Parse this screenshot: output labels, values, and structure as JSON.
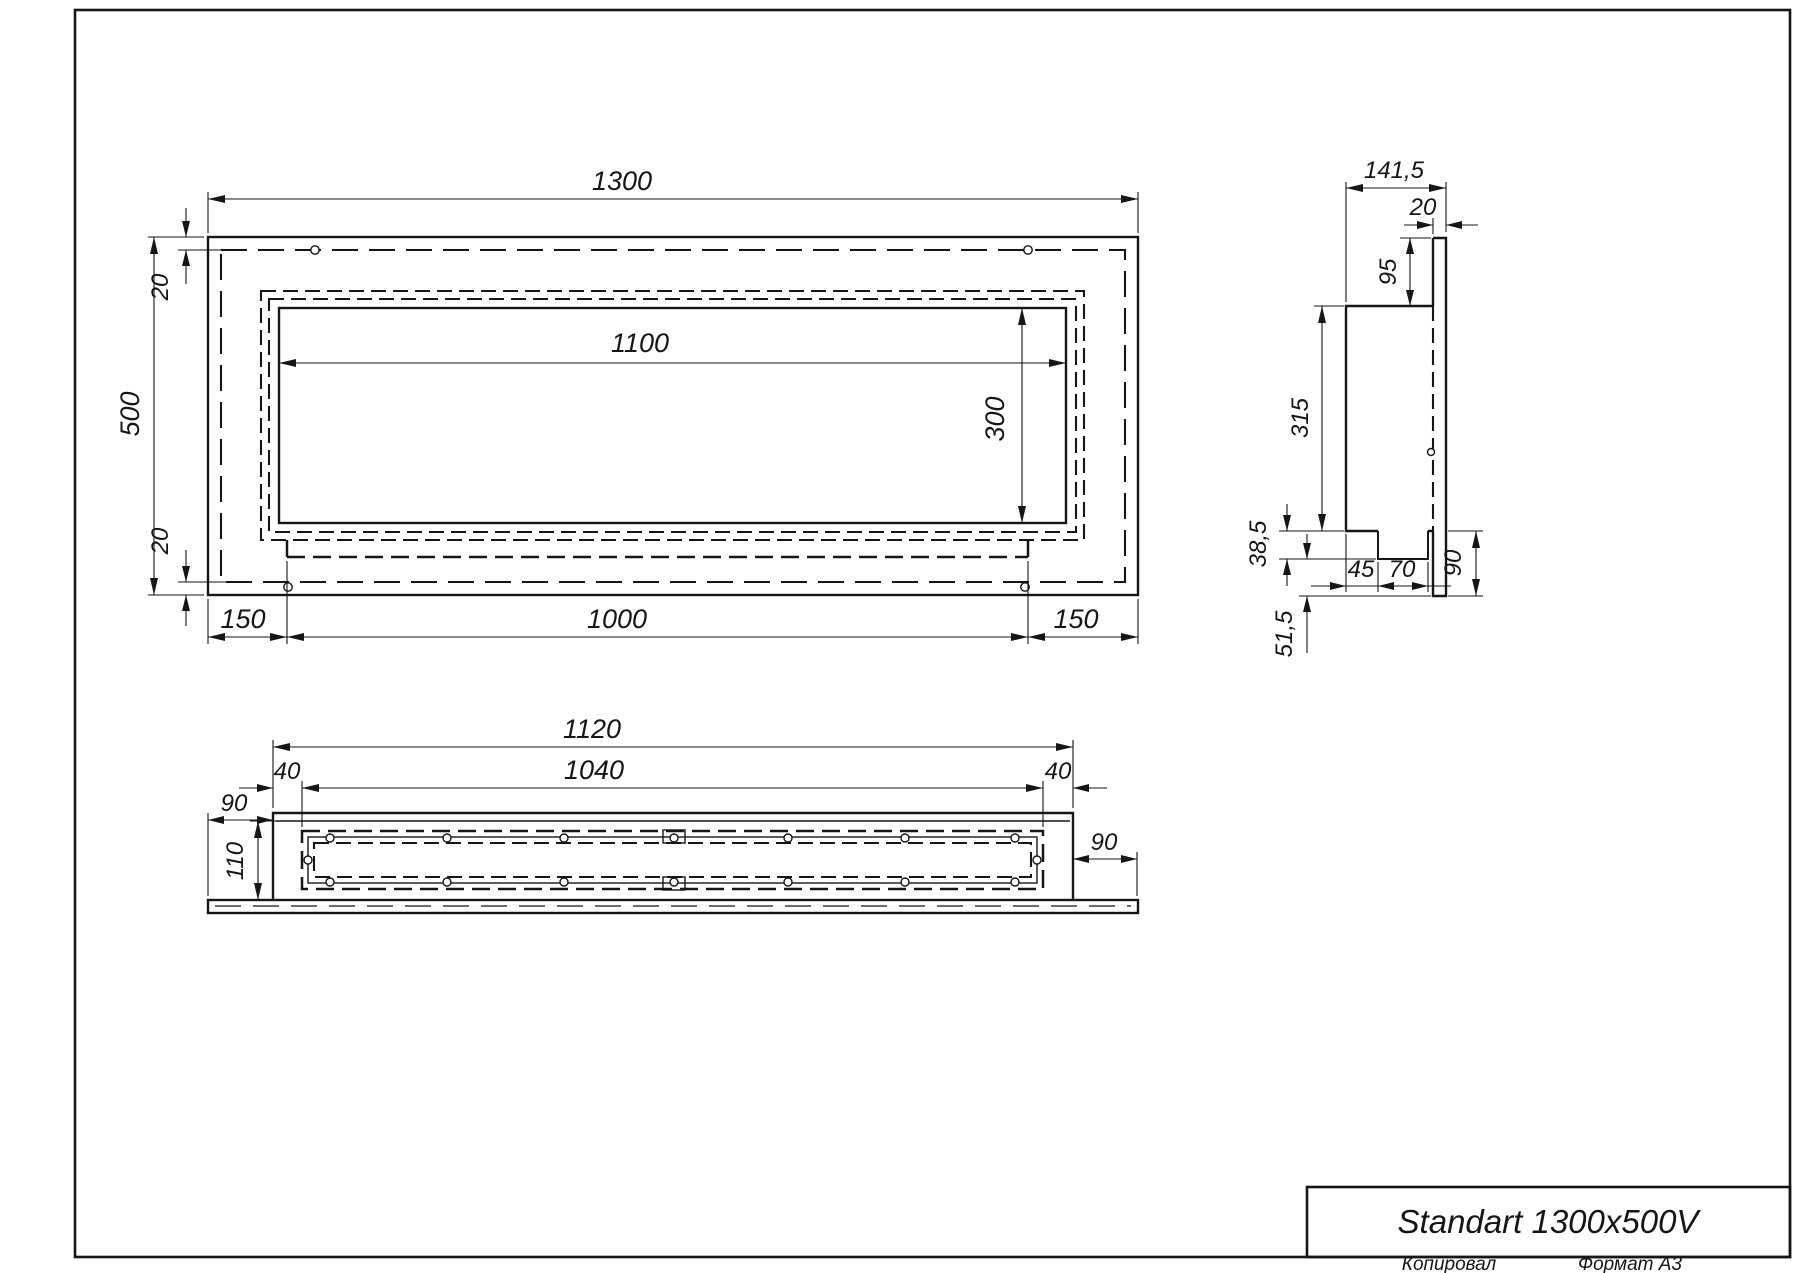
{
  "title_block": {
    "title": "Standart 1300x500V"
  },
  "footer": {
    "copied_label": "Копировал",
    "format_label": "Формат А3"
  },
  "front_view": {
    "dims": {
      "width": "1300",
      "height": "500",
      "flange_top": "20",
      "flange_bottom": "20",
      "opening_width": "1100",
      "opening_height": "300",
      "margin_left": "150",
      "burner_width": "1000",
      "margin_right": "150"
    }
  },
  "side_view": {
    "dims": {
      "depth": "141,5",
      "plate_thickness": "20",
      "top_offset": "95",
      "body_height": "315",
      "tray_drop": "38,5",
      "below_plate": "51,5",
      "tray_inset": "45",
      "tray_width": "70",
      "bottom_margin": "90"
    }
  },
  "bottom_view": {
    "dims": {
      "body_width": "1120",
      "chamber_width": "1040",
      "inset_left": "40",
      "inset_right": "40",
      "plate_margin_left": "90",
      "plate_margin_right": "90",
      "inner_depth": "110"
    }
  }
}
